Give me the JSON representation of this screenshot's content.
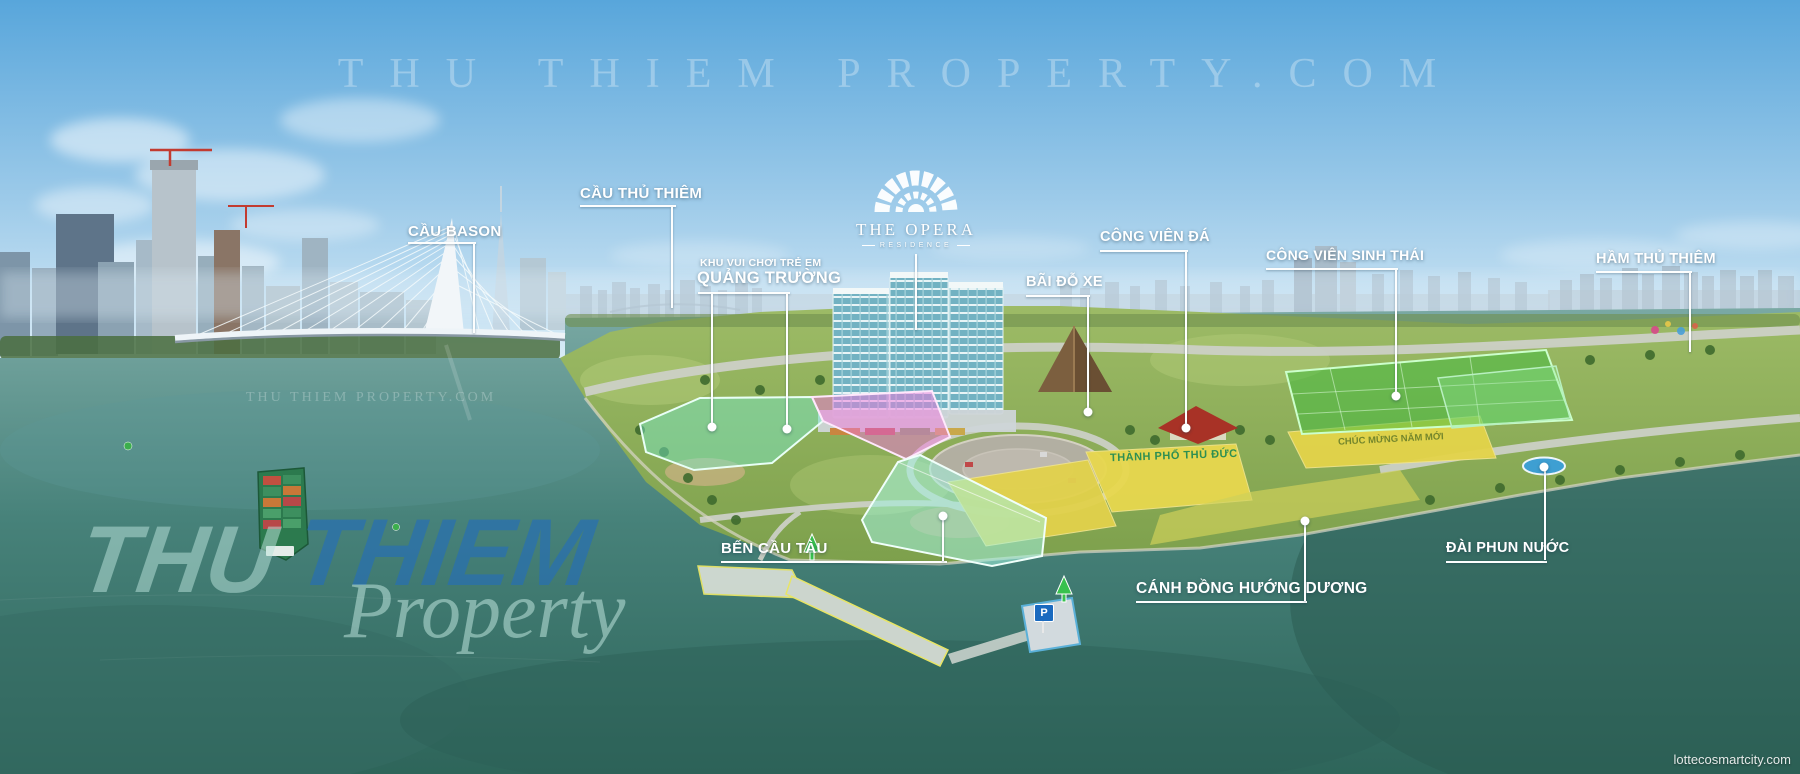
{
  "watermarks": {
    "top": "THU THIEM PROPERTY.COM",
    "mid": "THU THIEM PROPERTY.COM",
    "big_word1": "THU",
    "big_word2": "THIEM",
    "big_word3": "Property",
    "corner": "lottecosmartcity.com"
  },
  "logo": {
    "name": "THE OPERA",
    "sub": "RESIDENCE"
  },
  "labels": {
    "cau_bason": "CẦU BASON",
    "cau_thu_thiem": "CẦU THỦ THIÊM",
    "khu_vui_choi_line1": "KHU VUI CHƠI TRẺ EM",
    "khu_vui_choi_line2": "QUẢNG TRƯỜNG",
    "bai_do_xe": "BÃI ĐỖ XE",
    "cong_vien_da": "CÔNG VIÊN ĐÁ",
    "cong_vien_sinh_thai": "CÔNG VIÊN SINH THÁI",
    "ham_thu_thiem": "HẦM THỦ THIÊM",
    "ben_cau_tau": "BẾN CẦU TÀU",
    "canh_dong_huong_duong": "CÁNH ĐỒNG HƯỚNG DƯƠNG",
    "dai_phun_nuoc": "ĐÀI PHUN NƯỚC"
  },
  "ground_texts": {
    "board": "THÀNH PHỐ THỦ ĐỨC",
    "field": "CHÚC MỪNG NĂM MỚI"
  },
  "markers": {
    "parking_sign": "P"
  },
  "colors": {
    "sky_top": "#58a6db",
    "water_deep": "#2e655a",
    "highlight_teal": "#7de8cd",
    "highlight_pink": "#f07ad8",
    "highlight_yellow": "#e8d84e",
    "highlight_green": "#3dbc3d",
    "label_white": "#ffffff",
    "watermark_blue": "#266eb6",
    "parking_blue": "#1a6abf"
  }
}
